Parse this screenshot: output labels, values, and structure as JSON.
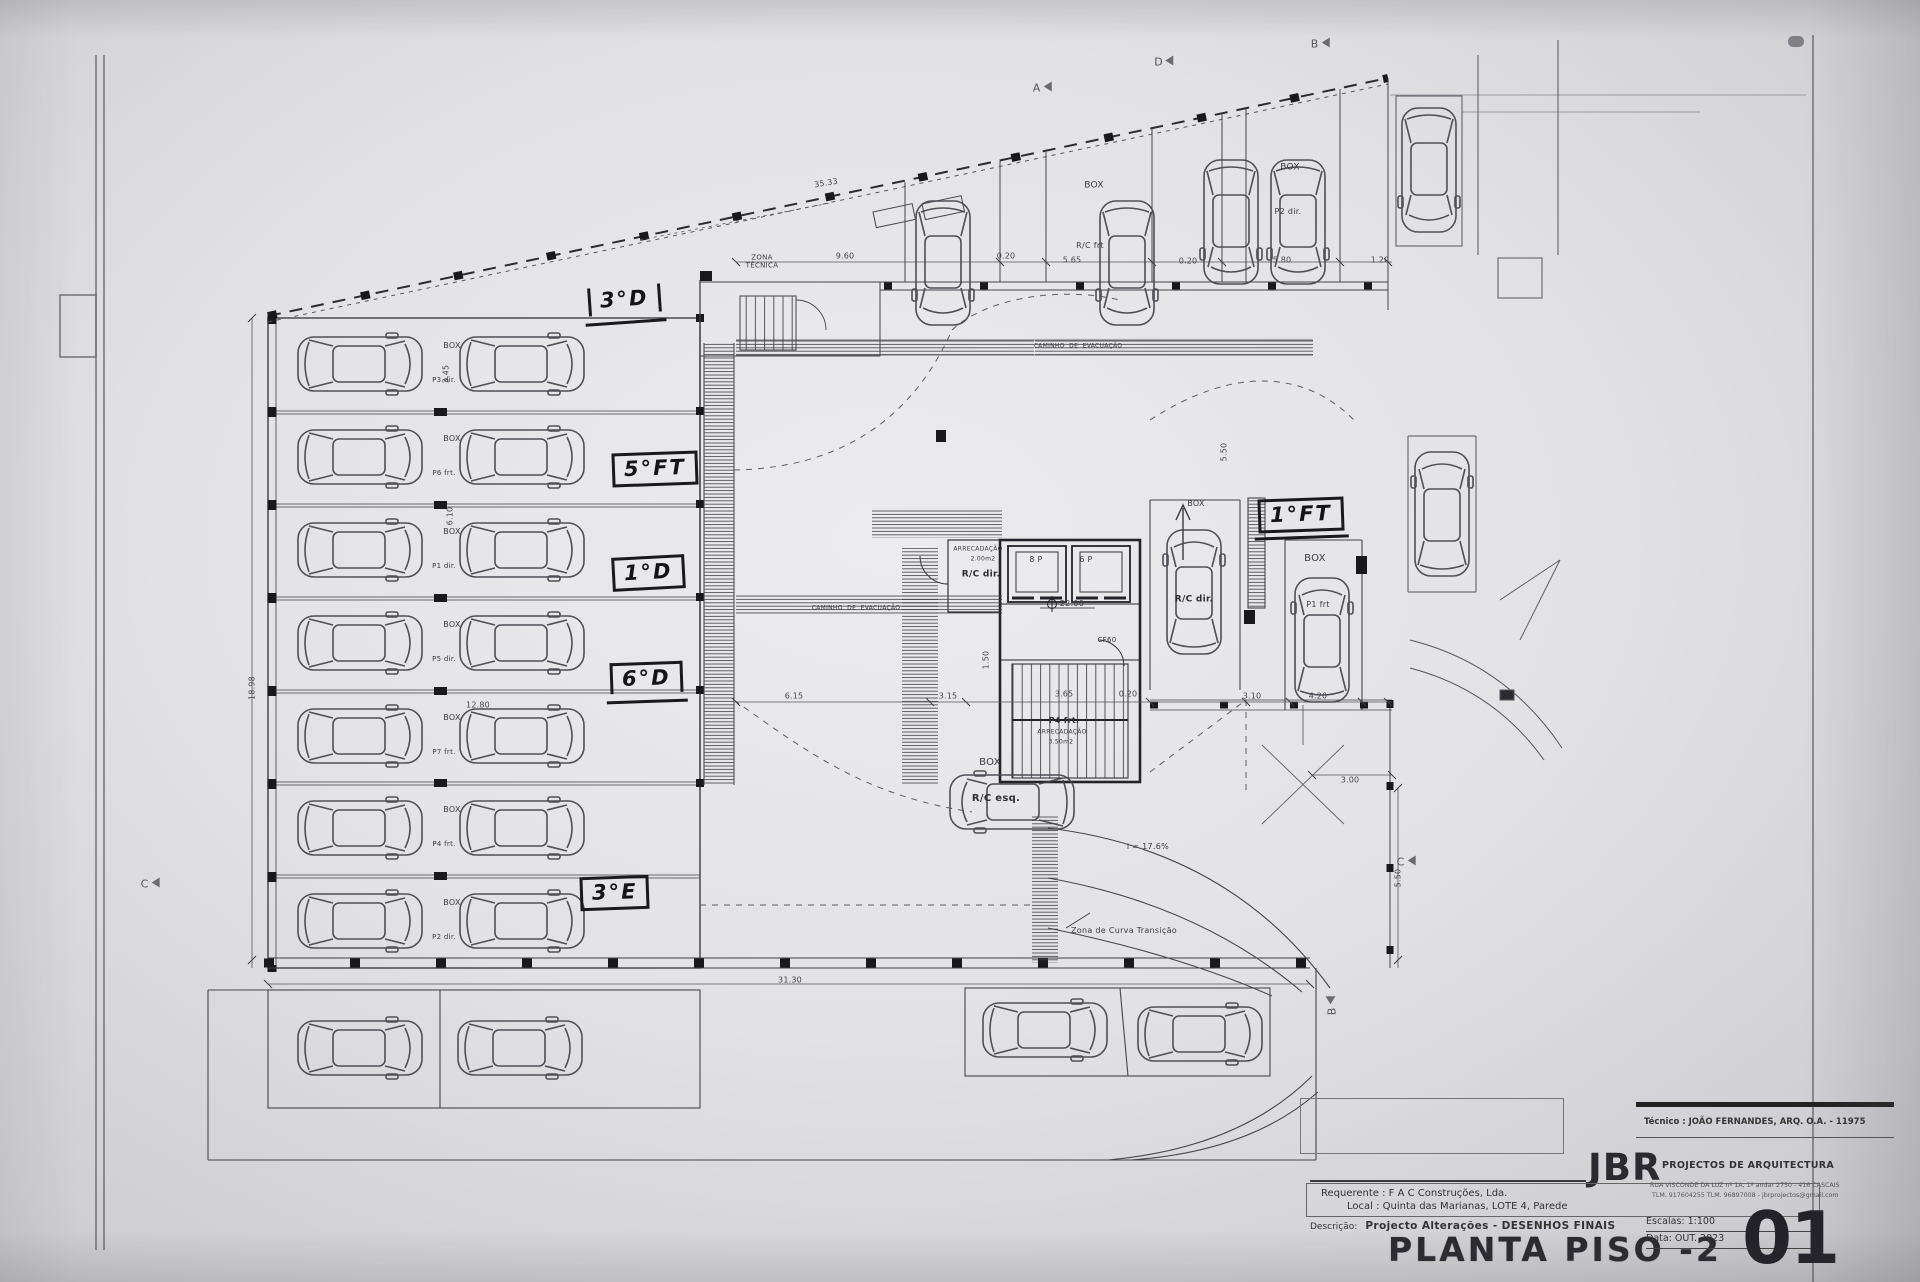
{
  "sheet": {
    "title": "PLANTA PISO -2",
    "number": "01",
    "scale": "Escalas:  1:100",
    "date": "Data: OUT.  2023",
    "technician": "Técnico : JOÃO FERNANDES, ARQ.   O.A. - 11975",
    "firm": "JBR",
    "firm_subtitle": "PROJECTOS DE ARQUITECTURA",
    "firm_address": "RUA VISCONDE DA LUZ nº 1A, 1º andar  2750 - 416  CASCAIS",
    "firm_contacts": "TLM. 917604255  TLM. 96897008 - jbrprojectos@gmail.com",
    "requerente": "Requerente : F A C  Construções, Lda.",
    "local": "Local : Quinta das Marianas, LOTE 4, Parede",
    "descricao_label": "Descrição:",
    "descricao_value": "Projecto Alterações - DESENHOS FINAIS",
    "ink_color": "#3a3a40",
    "paper_color": "#e6e6e8"
  },
  "plan": {
    "handwritten": [
      {
        "text": "3°D"
      },
      {
        "text": "5°FT"
      },
      {
        "text": "1°D"
      },
      {
        "text": "6°D"
      },
      {
        "text": "3°E"
      },
      {
        "text": "1°FT"
      }
    ],
    "labels": [
      {
        "name": "zona-tecnica-label",
        "text": "ZONA\nTÉCNICA",
        "x": 762,
        "y": 262,
        "size": 7
      },
      {
        "name": "caminho-evacuacao-top",
        "text": "CAMINHO  DE  EVACUAÇÃO",
        "x": 1078,
        "y": 346,
        "size": 6
      },
      {
        "name": "caminho-evacuacao-mid",
        "text": "CAMINHO  DE  EVACUAÇÃO",
        "x": 856,
        "y": 608,
        "size": 6
      },
      {
        "name": "box-top-center",
        "text": "BOX",
        "x": 1094,
        "y": 186,
        "size": 9
      },
      {
        "name": "stall-rc-frt",
        "text": "R/C frt",
        "x": 1090,
        "y": 246,
        "size": 8
      },
      {
        "name": "box-top-right",
        "text": "BOX",
        "x": 1290,
        "y": 168,
        "size": 9
      },
      {
        "name": "stall-p2-dir",
        "text": "P2 dir.",
        "x": 1288,
        "y": 212,
        "size": 8
      },
      {
        "name": "arrecadacao-room",
        "text": "ARRECADAÇÃO",
        "x": 978,
        "y": 549,
        "size": 6
      },
      {
        "name": "arrecadacao-room-area",
        "text": "2.00m2",
        "x": 983,
        "y": 559,
        "size": 6
      },
      {
        "name": "room-rc-dir",
        "text": "R/C dir.",
        "x": 981,
        "y": 575,
        "size": 9,
        "bold": true
      },
      {
        "name": "lift-8p",
        "text": "8 P",
        "x": 1036,
        "y": 560,
        "size": 8
      },
      {
        "name": "lift-6p",
        "text": "6 P",
        "x": 1086,
        "y": 560,
        "size": 8
      },
      {
        "name": "level-mark",
        "text": "22.00",
        "x": 1072,
        "y": 604,
        "size": 8
      },
      {
        "name": "door-cf60",
        "text": "CF60",
        "x": 1107,
        "y": 640,
        "size": 7
      },
      {
        "name": "stall-p4-frt",
        "text": "P4 frt.",
        "x": 1064,
        "y": 721,
        "size": 8,
        "bold": true
      },
      {
        "name": "arrecadacao-p4",
        "text": "ARRECADAÇÃO",
        "x": 1062,
        "y": 732,
        "size": 6
      },
      {
        "name": "arrecadacao-p4-area",
        "text": "3.50m2",
        "x": 1061,
        "y": 742,
        "size": 6
      },
      {
        "name": "box-center",
        "text": "BOX",
        "x": 990,
        "y": 763,
        "size": 10
      },
      {
        "name": "stall-rc-esq",
        "text": "R/C esq.",
        "x": 996,
        "y": 799,
        "size": 10,
        "bold": true
      },
      {
        "name": "box-rc-dir",
        "text": "BOX",
        "x": 1196,
        "y": 504,
        "size": 8
      },
      {
        "name": "stall-rc-dir",
        "text": "R/C dir.",
        "x": 1194,
        "y": 600,
        "size": 9,
        "bold": true
      },
      {
        "name": "box-right",
        "text": "BOX",
        "x": 1315,
        "y": 559,
        "size": 10
      },
      {
        "name": "stall-p1-frt",
        "text": "P1 frt",
        "x": 1318,
        "y": 605,
        "size": 8
      },
      {
        "name": "ramp-slope",
        "text": "i = 17.6%",
        "x": 1148,
        "y": 847,
        "size": 8
      },
      {
        "name": "zona-curva-transicao",
        "text": "Zona de Curva Transição",
        "x": 1124,
        "y": 931,
        "size": 8
      },
      {
        "name": "box-row-1",
        "text": "BOX",
        "x": 452,
        "y": 346,
        "size": 8
      },
      {
        "name": "box-row-2",
        "text": "BOX",
        "x": 452,
        "y": 439,
        "size": 8
      },
      {
        "name": "box-row-3",
        "text": "BOX",
        "x": 452,
        "y": 532,
        "size": 8
      },
      {
        "name": "box-row-4",
        "text": "BOX",
        "x": 452,
        "y": 625,
        "size": 8
      },
      {
        "name": "box-row-5",
        "text": "BOX",
        "x": 452,
        "y": 718,
        "size": 8
      },
      {
        "name": "box-row-6",
        "text": "BOX",
        "x": 452,
        "y": 810,
        "size": 8
      },
      {
        "name": "box-row-7",
        "text": "BOX",
        "x": 452,
        "y": 903,
        "size": 8
      },
      {
        "name": "stall-p3-dir",
        "text": "P3 dir.",
        "x": 444,
        "y": 380,
        "size": 7
      },
      {
        "name": "stall-p6-frt",
        "text": "P6 frt.",
        "x": 444,
        "y": 473,
        "size": 7
      },
      {
        "name": "stall-p1-dir",
        "text": "P1 dir.",
        "x": 444,
        "y": 566,
        "size": 7
      },
      {
        "name": "stall-p5-dir",
        "text": "P5 dir.",
        "x": 444,
        "y": 659,
        "size": 7
      },
      {
        "name": "stall-p7-frt",
        "text": "P7 frt.",
        "x": 444,
        "y": 752,
        "size": 7
      },
      {
        "name": "stall-p4-frt-left",
        "text": "P4 frt.",
        "x": 444,
        "y": 844,
        "size": 7
      },
      {
        "name": "stall-p2-dir-left",
        "text": "P2 dir.",
        "x": 444,
        "y": 937,
        "size": 7
      }
    ],
    "dimensions": [
      {
        "text": "35.33",
        "x": 826,
        "y": 183,
        "rot": -9
      },
      {
        "text": "9.60",
        "x": 845,
        "y": 256
      },
      {
        "text": "0.20",
        "x": 1006,
        "y": 256
      },
      {
        "text": "5.65",
        "x": 1072,
        "y": 260
      },
      {
        "text": "0.20",
        "x": 1188,
        "y": 261
      },
      {
        "text": "5.80",
        "x": 1282,
        "y": 260
      },
      {
        "text": "1.20",
        "x": 1380,
        "y": 260
      },
      {
        "text": "5.50",
        "x": 1224,
        "y": 452,
        "rot": -90
      },
      {
        "text": "1.50",
        "x": 986,
        "y": 660,
        "rot": -90
      },
      {
        "text": "6.15",
        "x": 794,
        "y": 696
      },
      {
        "text": "3.15",
        "x": 948,
        "y": 696
      },
      {
        "text": "3.65",
        "x": 1064,
        "y": 694
      },
      {
        "text": "0.20",
        "x": 1128,
        "y": 694
      },
      {
        "text": "3.10",
        "x": 1252,
        "y": 696
      },
      {
        "text": "4.20",
        "x": 1318,
        "y": 696
      },
      {
        "text": "12.80",
        "x": 478,
        "y": 705
      },
      {
        "text": "31.30",
        "x": 790,
        "y": 980
      },
      {
        "text": "18.98",
        "x": 252,
        "y": 688,
        "rot": -90
      },
      {
        "text": "3.00",
        "x": 1350,
        "y": 780
      },
      {
        "text": "5.50",
        "x": 1398,
        "y": 878,
        "rot": -90
      },
      {
        "text": "3.45",
        "x": 446,
        "y": 374,
        "rot": -90
      },
      {
        "text": "6.10",
        "x": 450,
        "y": 516,
        "rot": -90
      }
    ],
    "section_markers": [
      {
        "letter": "A",
        "x": 1042,
        "y": 88
      },
      {
        "letter": "D",
        "x": 1164,
        "y": 62
      },
      {
        "letter": "B",
        "x": 1320,
        "y": 44
      },
      {
        "letter": "C",
        "x": 150,
        "y": 884
      },
      {
        "letter": "C",
        "x": 1406,
        "y": 862
      },
      {
        "letter": "B",
        "x": 1332,
        "y": 1006,
        "rot": -90
      }
    ]
  }
}
